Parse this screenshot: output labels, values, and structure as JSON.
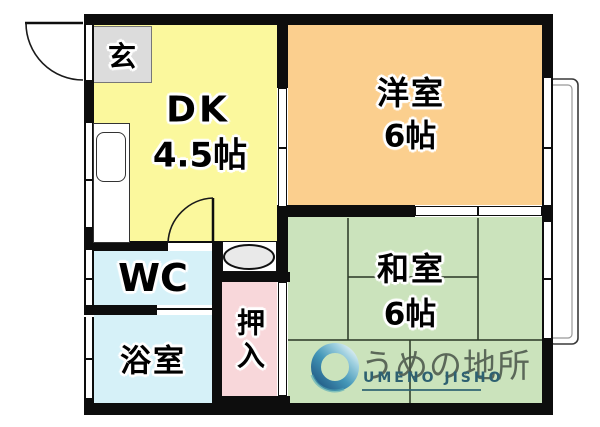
{
  "rooms": {
    "genkan": {
      "label": "玄"
    },
    "dk": {
      "label": "DK",
      "size": "4.5帖"
    },
    "western": {
      "label": "洋室",
      "size": "6帖"
    },
    "japanese": {
      "label": "和室",
      "size": "6帖"
    },
    "wc": {
      "label": "WC"
    },
    "bath": {
      "label": "浴室"
    },
    "closet": {
      "label": "押入"
    }
  },
  "logo": {
    "name": "うめの地所",
    "romaji": "UMENO JISHO"
  },
  "colors": {
    "wall": "#0d0d0d",
    "dk_yellow": "#fbf89d",
    "western_orange": "#fbcf8e",
    "japanese_green": "#cbe3bc",
    "water_cyan": "#d6f1f8",
    "closet_pink": "#f8d7da",
    "genkan_gray": "#dcdcdc",
    "tatami_line": "#32402d",
    "logo_text": "#4a524a",
    "logo_romaji_teal": "#2e6171",
    "logo_ring_dark": "#17507f",
    "logo_ring_light": "#e9f4f7"
  }
}
